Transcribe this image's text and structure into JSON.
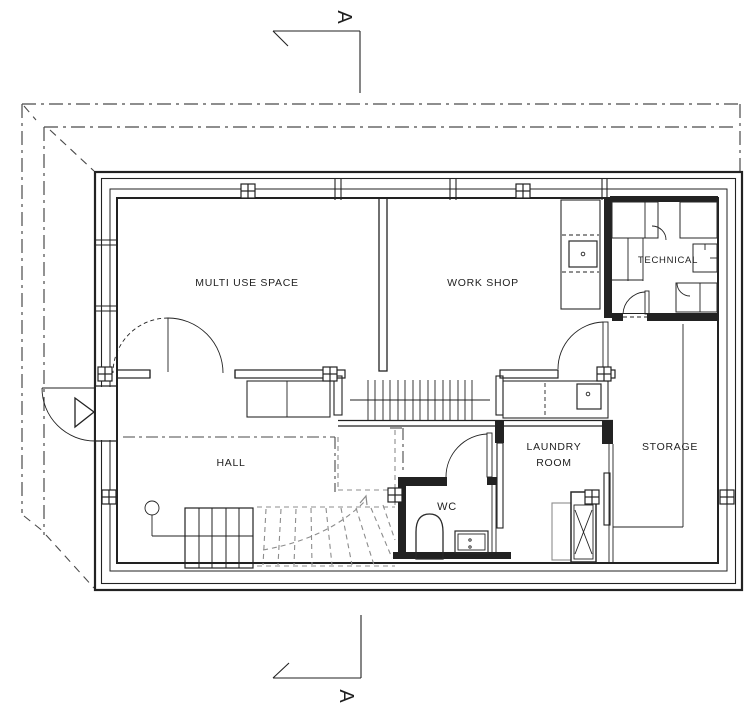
{
  "drawing_type": "architectural floor plan",
  "section_markers": {
    "top": "A",
    "bottom": "A"
  },
  "labels": {
    "multi_use_space": "MULTI USE SPACE",
    "work_shop": "WORK SHOP",
    "technical": "TECHNICAL",
    "hall": "HALL",
    "wc": "WC",
    "laundry_line1": "LAUNDRY",
    "laundry_line2": "ROOM",
    "storage": "STORAGE"
  },
  "colors": {
    "line": "#222222",
    "background": "#ffffff",
    "dashed_gray": "#8c8c8c",
    "dashdot": "#4a4a4a"
  }
}
